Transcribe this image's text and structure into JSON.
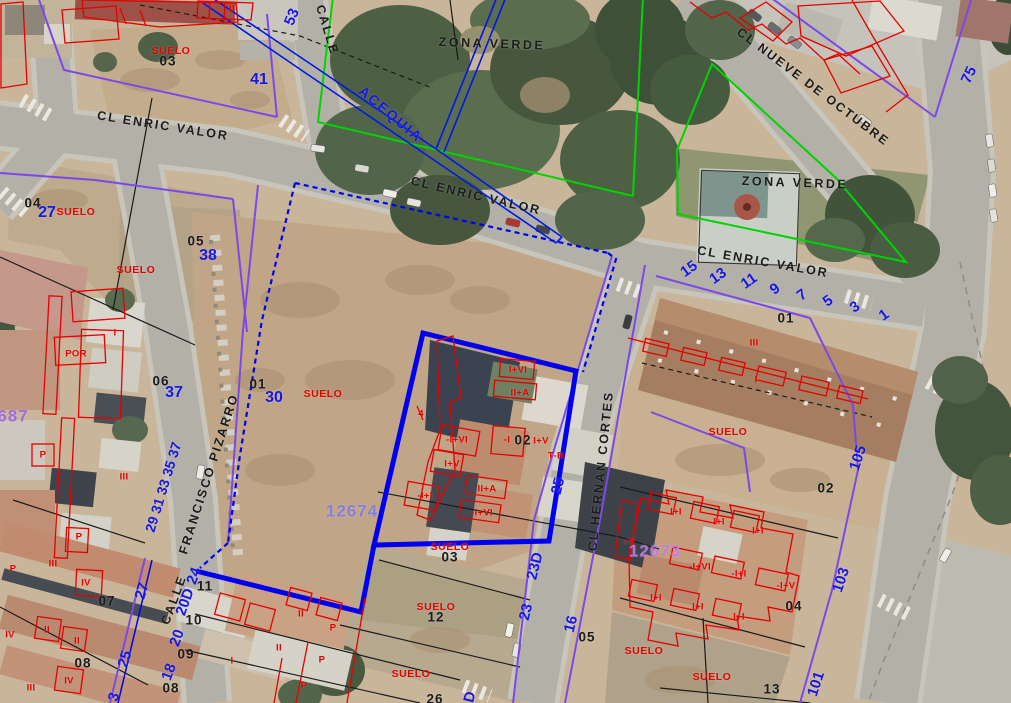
{
  "map": {
    "colors": {
      "street_text": "#1c1c1c",
      "blue_number": "#1717e8",
      "red_label": "#e60000",
      "parcel_line_purple": "#7b49e8",
      "selection_blue": "#0000ee",
      "acequia_blue": "#0018e6",
      "green_zone_line": "#00d400",
      "black_line": "#1a1a1a"
    },
    "class_names": {
      "street": "street-name-label",
      "zone": "green-zone-label",
      "aceq": "acequia-label",
      "bnum": "parcel-number-label",
      "blue": "house-number-label",
      "pid": "parcel-id-label",
      "suelo": "suelo-label",
      "red": "construction-label"
    },
    "parcel_ids": [
      "12674",
      "12673",
      "687"
    ],
    "labels": [
      {
        "t": "CALLE",
        "x": 327,
        "y": 30,
        "r": 73,
        "c": "street"
      },
      {
        "t": "CL ENRIC VALOR",
        "x": 163,
        "y": 126,
        "r": 9,
        "c": "street"
      },
      {
        "t": "CL ENRIC VALOR",
        "x": 476,
        "y": 196,
        "r": 13,
        "c": "street"
      },
      {
        "t": "CL ENRIC VALOR",
        "x": 763,
        "y": 262,
        "r": 10,
        "c": "street"
      },
      {
        "t": "CL NUEVE DE OCTUBRE",
        "x": 813,
        "y": 87,
        "r": 37,
        "c": "street"
      },
      {
        "t": "CALLE",
        "x": 174,
        "y": 600,
        "r": -70,
        "c": "street"
      },
      {
        "t": "FRANCISCO PIZARRO",
        "x": 209,
        "y": 474,
        "r": -72,
        "c": "street"
      },
      {
        "t": "CL HERNAN CORTES",
        "x": 601,
        "y": 471,
        "r": -84,
        "c": "street"
      },
      {
        "t": "ZONA VERDE",
        "x": 492,
        "y": 44,
        "r": 2,
        "c": "zone"
      },
      {
        "t": "ZONA VERDE",
        "x": 795,
        "y": 183,
        "r": 2,
        "c": "zone"
      },
      {
        "t": "ACEQUIA",
        "x": 391,
        "y": 114,
        "r": 40,
        "c": "aceq"
      },
      {
        "t": "03",
        "x": 168,
        "y": 61,
        "c": "bnum"
      },
      {
        "t": "04",
        "x": 33,
        "y": 203,
        "c": "bnum"
      },
      {
        "t": "05",
        "x": 196,
        "y": 241,
        "c": "bnum"
      },
      {
        "t": "06",
        "x": 161,
        "y": 381,
        "c": "bnum"
      },
      {
        "t": "01",
        "x": 258,
        "y": 384,
        "c": "bnum"
      },
      {
        "t": "07",
        "x": 107,
        "y": 601,
        "c": "bnum"
      },
      {
        "t": "08",
        "x": 83,
        "y": 663,
        "c": "bnum"
      },
      {
        "t": "09",
        "x": 186,
        "y": 654,
        "c": "bnum"
      },
      {
        "t": "10",
        "x": 194,
        "y": 620,
        "c": "bnum"
      },
      {
        "t": "11",
        "x": 205,
        "y": 586,
        "c": "bnum"
      },
      {
        "t": "08",
        "x": 171,
        "y": 688,
        "c": "bnum"
      },
      {
        "t": "01",
        "x": 786,
        "y": 318,
        "c": "bnum"
      },
      {
        "t": "02",
        "x": 826,
        "y": 488,
        "c": "bnum"
      },
      {
        "t": "02",
        "x": 523,
        "y": 440,
        "c": "bnum"
      },
      {
        "t": "03",
        "x": 450,
        "y": 557,
        "c": "bnum"
      },
      {
        "t": "12",
        "x": 436,
        "y": 617,
        "c": "bnum"
      },
      {
        "t": "26",
        "x": 435,
        "y": 699,
        "c": "bnum"
      },
      {
        "t": "05",
        "x": 587,
        "y": 637,
        "c": "bnum"
      },
      {
        "t": "04",
        "x": 794,
        "y": 606,
        "c": "bnum"
      },
      {
        "t": "13",
        "x": 772,
        "y": 689,
        "c": "bnum"
      },
      {
        "t": "53",
        "x": 292,
        "y": 17,
        "r": -68,
        "c": "blue"
      },
      {
        "t": "41",
        "x": 259,
        "y": 80,
        "s": 16,
        "c": "blue"
      },
      {
        "t": "27",
        "x": 47,
        "y": 213,
        "s": 16,
        "c": "blue"
      },
      {
        "t": "38",
        "x": 208,
        "y": 256,
        "s": 16,
        "c": "blue"
      },
      {
        "t": "37",
        "x": 174,
        "y": 393,
        "s": 16,
        "c": "blue"
      },
      {
        "t": "30",
        "x": 274,
        "y": 398,
        "s": 16,
        "c": "blue"
      },
      {
        "t": "29 31 33 35 37",
        "x": 163,
        "y": 487,
        "r": -73,
        "s": 14,
        "c": "blue"
      },
      {
        "t": "27",
        "x": 142,
        "y": 591,
        "r": -73,
        "c": "blue"
      },
      {
        "t": "25",
        "x": 125,
        "y": 659,
        "r": -73,
        "c": "blue"
      },
      {
        "t": "3",
        "x": 114,
        "y": 697,
        "r": -73,
        "c": "blue"
      },
      {
        "t": "24",
        "x": 194,
        "y": 576,
        "r": -70,
        "c": "blue"
      },
      {
        "t": "20D",
        "x": 185,
        "y": 602,
        "r": -70,
        "c": "blue"
      },
      {
        "t": "20",
        "x": 177,
        "y": 638,
        "r": -70,
        "c": "blue"
      },
      {
        "t": "18",
        "x": 169,
        "y": 672,
        "r": -70,
        "c": "blue"
      },
      {
        "t": "15",
        "x": 689,
        "y": 269,
        "r": -35,
        "c": "blue"
      },
      {
        "t": "13",
        "x": 718,
        "y": 276,
        "r": -35,
        "c": "blue"
      },
      {
        "t": "11",
        "x": 749,
        "y": 281,
        "r": -35,
        "c": "blue"
      },
      {
        "t": "9",
        "x": 775,
        "y": 289,
        "r": -35,
        "c": "blue"
      },
      {
        "t": "7",
        "x": 802,
        "y": 295,
        "r": -35,
        "c": "blue"
      },
      {
        "t": "5",
        "x": 828,
        "y": 301,
        "r": -35,
        "c": "blue"
      },
      {
        "t": "3",
        "x": 855,
        "y": 307,
        "r": -35,
        "c": "blue"
      },
      {
        "t": "1",
        "x": 884,
        "y": 315,
        "r": -35,
        "c": "blue"
      },
      {
        "t": "105",
        "x": 858,
        "y": 458,
        "r": -72,
        "c": "blue"
      },
      {
        "t": "103",
        "x": 841,
        "y": 580,
        "r": -72,
        "c": "blue"
      },
      {
        "t": "101",
        "x": 816,
        "y": 684,
        "r": -72,
        "c": "blue"
      },
      {
        "t": "75",
        "x": 969,
        "y": 75,
        "r": -65,
        "c": "blue"
      },
      {
        "t": "25",
        "x": 558,
        "y": 486,
        "r": -76,
        "c": "blue"
      },
      {
        "t": "23D",
        "x": 535,
        "y": 566,
        "r": -76,
        "c": "blue"
      },
      {
        "t": "23",
        "x": 526,
        "y": 612,
        "r": -76,
        "c": "blue"
      },
      {
        "t": "16",
        "x": 571,
        "y": 624,
        "r": -76,
        "c": "blue"
      },
      {
        "t": "D",
        "x": 470,
        "y": 697,
        "r": -76,
        "c": "blue"
      },
      {
        "t": "12674",
        "x": 352,
        "y": 511,
        "col": "#8079e8",
        "c": "pid"
      },
      {
        "t": "12673",
        "x": 655,
        "y": 551,
        "col": "#bd7ce8",
        "c": "pid"
      },
      {
        "t": "687",
        "x": 13,
        "y": 416,
        "col": "#9a63e6",
        "c": "pid"
      },
      {
        "t": "SUELO",
        "x": 171,
        "y": 51,
        "c": "suelo"
      },
      {
        "t": "SUELO",
        "x": 76,
        "y": 212,
        "c": "suelo"
      },
      {
        "t": "SUELO",
        "x": 136,
        "y": 270,
        "c": "suelo"
      },
      {
        "t": "SUELO",
        "x": 323,
        "y": 394,
        "c": "suelo"
      },
      {
        "t": "SUELO",
        "x": 450,
        "y": 547,
        "c": "suelo"
      },
      {
        "t": "SUELO",
        "x": 436,
        "y": 607,
        "c": "suelo"
      },
      {
        "t": "SUELO",
        "x": 411,
        "y": 674,
        "c": "suelo"
      },
      {
        "t": "SUELO",
        "x": 728,
        "y": 432,
        "c": "suelo"
      },
      {
        "t": "SUELO",
        "x": 644,
        "y": 651,
        "c": "suelo"
      },
      {
        "t": "SUELO",
        "x": 712,
        "y": 677,
        "c": "suelo"
      },
      {
        "t": "II",
        "x": 232,
        "y": 9,
        "c": "red"
      },
      {
        "t": "POR",
        "x": 76,
        "y": 354,
        "c": "red"
      },
      {
        "t": "I",
        "x": 115,
        "y": 333,
        "c": "red"
      },
      {
        "t": "P",
        "x": 43,
        "y": 455,
        "c": "red"
      },
      {
        "t": "III",
        "x": 124,
        "y": 477,
        "c": "red"
      },
      {
        "t": "P",
        "x": 79,
        "y": 537,
        "c": "red"
      },
      {
        "t": "III",
        "x": 53,
        "y": 564,
        "c": "red"
      },
      {
        "t": "IV",
        "x": 86,
        "y": 583,
        "c": "red"
      },
      {
        "t": "P",
        "x": 13,
        "y": 569,
        "c": "red"
      },
      {
        "t": "IV",
        "x": 10,
        "y": 635,
        "c": "red"
      },
      {
        "t": "II",
        "x": 47,
        "y": 630,
        "c": "red"
      },
      {
        "t": "II",
        "x": 77,
        "y": 641,
        "c": "red"
      },
      {
        "t": "IV",
        "x": 69,
        "y": 681,
        "c": "red"
      },
      {
        "t": "III",
        "x": 31,
        "y": 688,
        "c": "red"
      },
      {
        "t": "4",
        "x": 421,
        "y": 414,
        "c": "red"
      },
      {
        "t": "I+VI",
        "x": 518,
        "y": 370,
        "c": "red"
      },
      {
        "t": "II+A",
        "x": 520,
        "y": 393,
        "c": "red"
      },
      {
        "t": "-I+VI",
        "x": 457,
        "y": 440,
        "c": "red"
      },
      {
        "t": "-I",
        "x": 507,
        "y": 440,
        "c": "red"
      },
      {
        "t": "I+V",
        "x": 541,
        "y": 441,
        "c": "red"
      },
      {
        "t": "T-B",
        "x": 556,
        "y": 456,
        "c": "red"
      },
      {
        "t": "I+V",
        "x": 452,
        "y": 464,
        "c": "red"
      },
      {
        "t": "-I+I",
        "x": 425,
        "y": 496,
        "c": "red"
      },
      {
        "t": "II+A",
        "x": 487,
        "y": 489,
        "c": "red"
      },
      {
        "t": "-I+VI",
        "x": 482,
        "y": 513,
        "c": "red"
      },
      {
        "t": "III",
        "x": 754,
        "y": 343,
        "c": "red"
      },
      {
        "t": "I",
        "x": 756,
        "y": 380,
        "c": "red"
      },
      {
        "t": "+V",
        "x": 629,
        "y": 542,
        "c": "red"
      },
      {
        "t": "I+I",
        "x": 676,
        "y": 512,
        "c": "red"
      },
      {
        "t": "I+I",
        "x": 719,
        "y": 522,
        "c": "red"
      },
      {
        "t": "I+I",
        "x": 758,
        "y": 531,
        "c": "red"
      },
      {
        "t": "-I+VI",
        "x": 700,
        "y": 567,
        "c": "red"
      },
      {
        "t": "-I+I",
        "x": 739,
        "y": 574,
        "c": "red"
      },
      {
        "t": "-I+V",
        "x": 786,
        "y": 586,
        "c": "red"
      },
      {
        "t": "I+I",
        "x": 656,
        "y": 598,
        "c": "red"
      },
      {
        "t": "I+I",
        "x": 698,
        "y": 607,
        "c": "red"
      },
      {
        "t": "I+I",
        "x": 739,
        "y": 617,
        "c": "red"
      },
      {
        "t": "II",
        "x": 301,
        "y": 614,
        "c": "red"
      },
      {
        "t": "II",
        "x": 279,
        "y": 648,
        "c": "red"
      },
      {
        "t": "I",
        "x": 232,
        "y": 661,
        "c": "red"
      },
      {
        "t": "P",
        "x": 333,
        "y": 628,
        "c": "red"
      },
      {
        "t": "P",
        "x": 322,
        "y": 660,
        "c": "red"
      },
      {
        "t": "P",
        "x": 304,
        "y": 686,
        "c": "red"
      }
    ]
  }
}
